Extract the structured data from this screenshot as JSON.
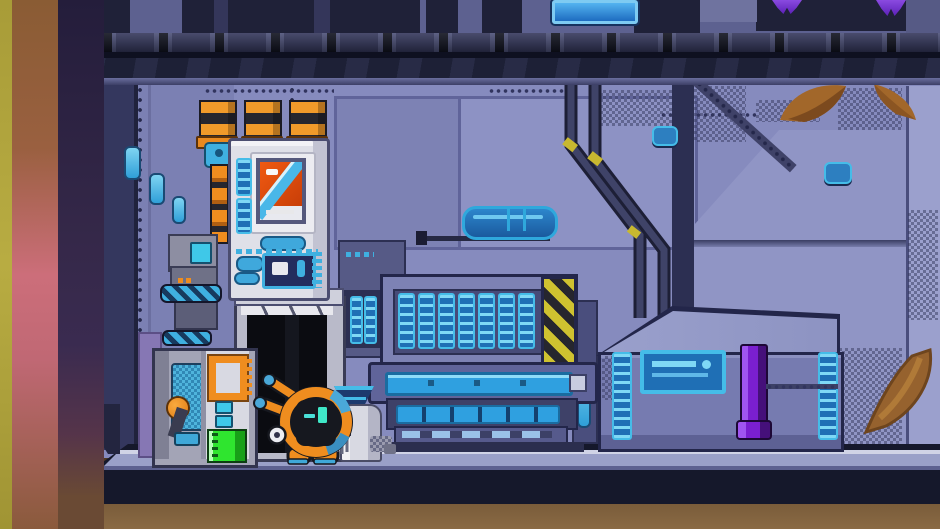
{
  "scene": {
    "name": "pixel-art spaceship interior",
    "description": "Engine bay room with a small round service robot, diagnostics console with smokestack pipes, dark doorway, ventilation unit with hazard stripe, and a large cargo crate with a purple pull lever.",
    "visible_text": "none"
  },
  "palette": {
    "wall": "#868bbe",
    "wall_light": "#9ba0cd",
    "wall_shadow": "#5d6190",
    "structure_dark": "#23264a",
    "ceiling_dark": "#1d2036",
    "accent_cyan": "#45bce8",
    "accent_blue_fill": "#1f6fb5",
    "machine_white": "#dfe0e8",
    "pipe_orange": "#ef8d1f",
    "screen_orange": "#e8500f",
    "hazard_yellow": "#cfc230",
    "lever_purple": "#7a1fd0",
    "gauge_green": "#2fe52f",
    "hull_brown": "#6e5233",
    "glow_pink": "#cc6e7a",
    "glow_olive": "#b0a83e",
    "doorway_black": "#0b0c11",
    "floor_light": "#9aa0c8",
    "floor_dark": "#15182b"
  },
  "entities": {
    "robot": {
      "label": "Round orange service robot with cyan eyes, twin antennae and claw"
    },
    "console": {
      "label": "Diagnostics console with three striped exhaust pipes",
      "screen": "orange display with cyan diagonal stripe",
      "pipes": 3
    },
    "doorway": {
      "label": "Dark service doorway"
    },
    "cabinet": {
      "label": "Utility cabinet with green level gauge and orange bracket"
    },
    "vent_machine": {
      "label": "Ventilation unit with seven blue slats and hazard stripe",
      "slats": 7
    },
    "crate": {
      "label": "Large cargo crate",
      "lever": "purple pull handle",
      "panel": "blue label plate"
    },
    "canister": {
      "label": "White canister"
    },
    "funnel": {
      "label": "Blue funnel hopper"
    },
    "tank": {
      "label": "Wall-mounted blue capsule tank"
    },
    "sign": {
      "label": "Blue ceiling panel light"
    },
    "claws": {
      "label": "Purple claw feet above ceiling"
    },
    "decals": {
      "label": "Rust-brown swoosh decals"
    }
  }
}
